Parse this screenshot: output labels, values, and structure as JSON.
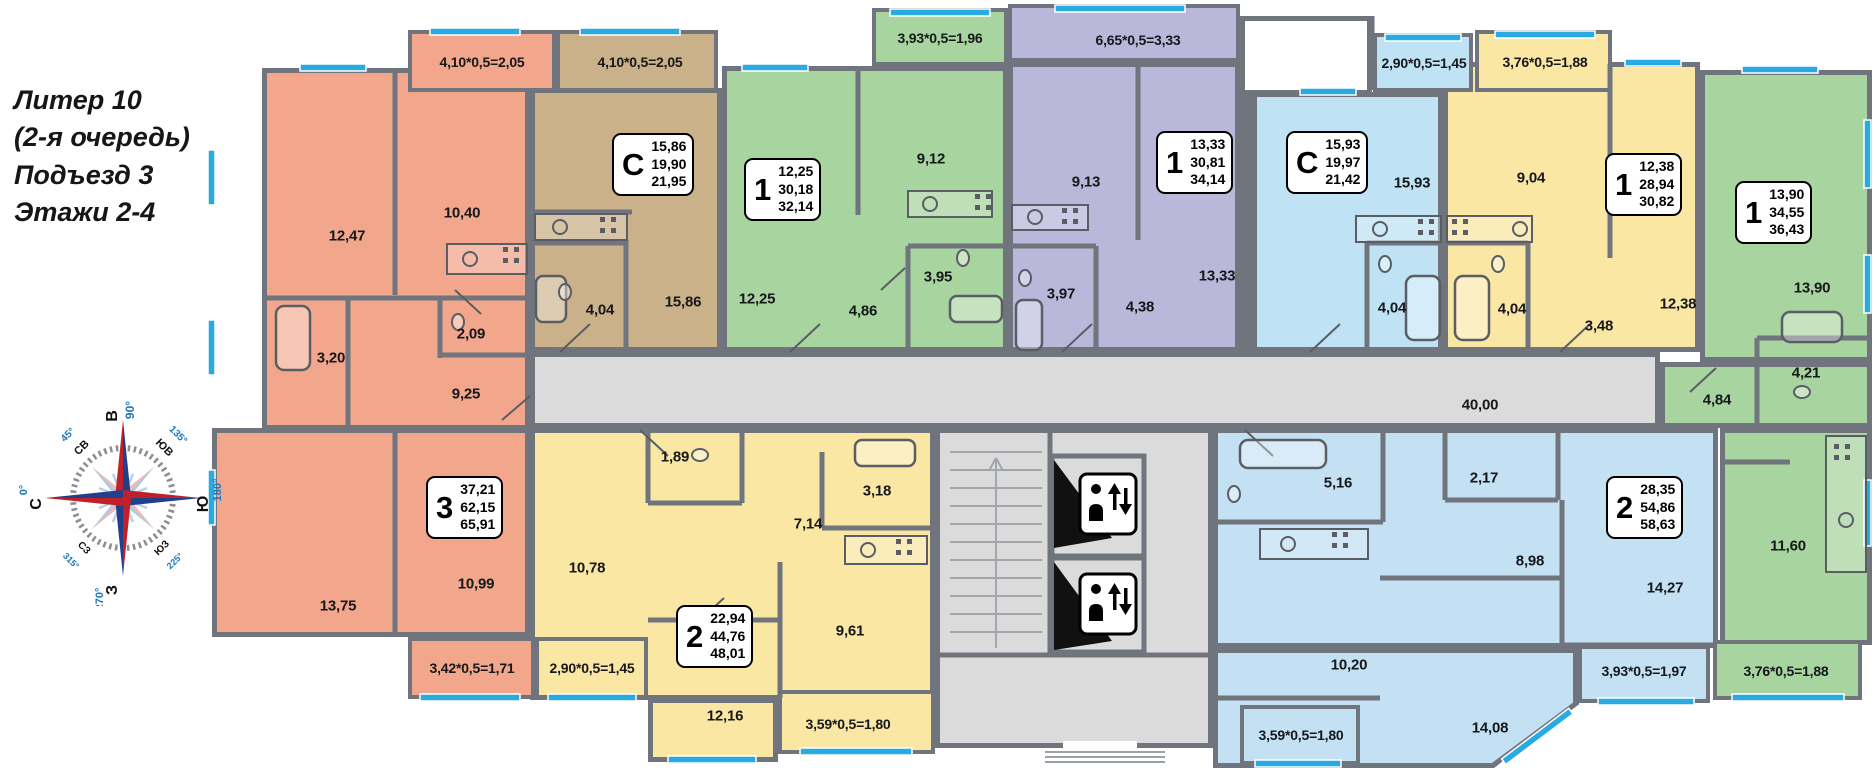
{
  "header": {
    "title_lines": [
      "Литер 10",
      "(2-я очередь)",
      "Подъезд 3",
      "Этажи 2-4"
    ]
  },
  "compass": {
    "directions": [
      {
        "label": "В",
        "deg": "90°"
      },
      {
        "label": "Ю",
        "deg": "180°"
      },
      {
        "label": "З",
        "deg": "270°"
      },
      {
        "label": "С",
        "deg": "0°"
      },
      {
        "label": "СВ",
        "deg": "45°"
      },
      {
        "label": "ЮВ",
        "deg": "135°"
      },
      {
        "label": "СЗ",
        "deg": "315°"
      },
      {
        "label": "ЮЗ",
        "deg": "225°"
      }
    ]
  },
  "corridor": {
    "area": "40,00"
  },
  "apartments": [
    {
      "id": "3-room-west",
      "type": "3",
      "living": "37,21",
      "area": "62,15",
      "total": "65,91",
      "rooms": [
        {
          "area": "12,47"
        },
        {
          "area": "10,40"
        },
        {
          "area": "2,09"
        },
        {
          "area": "3,20"
        },
        {
          "area": "9,25"
        },
        {
          "area": "10,99"
        },
        {
          "area": "13,75"
        }
      ],
      "balconies": [
        {
          "formula": "4,10*0,5=2,05"
        },
        {
          "formula": "3,42*0,5=1,71"
        }
      ]
    },
    {
      "id": "studio-west",
      "type": "С",
      "living": "15,86",
      "area": "19,90",
      "total": "21,95",
      "rooms": [
        {
          "area": "15,86"
        },
        {
          "area": "4,04"
        }
      ],
      "balconies": [
        {
          "formula": "4,10*0,5=2,05"
        }
      ]
    },
    {
      "id": "1-room-green-west",
      "type": "1",
      "living": "12,25",
      "area": "30,18",
      "total": "32,14",
      "rooms": [
        {
          "area": "12,25"
        },
        {
          "area": "9,12"
        },
        {
          "area": "3,95"
        },
        {
          "area": "4,86"
        }
      ],
      "balconies": [
        {
          "formula": "3,93*0,5=1,96"
        }
      ]
    },
    {
      "id": "1-room-purple",
      "type": "1",
      "living": "13,33",
      "area": "30,81",
      "total": "34,14",
      "rooms": [
        {
          "area": "13,33"
        },
        {
          "area": "9,13"
        },
        {
          "area": "3,97"
        },
        {
          "area": "4,38"
        }
      ],
      "balconies": [
        {
          "formula": "6,65*0,5=3,33"
        }
      ]
    },
    {
      "id": "studio-east",
      "type": "С",
      "living": "15,93",
      "area": "19,97",
      "total": "21,42",
      "rooms": [
        {
          "area": "15,93"
        },
        {
          "area": "4,04"
        }
      ],
      "balconies": [
        {
          "formula": "2,90*0,5=1,45"
        }
      ]
    },
    {
      "id": "1-room-yellow",
      "type": "1",
      "living": "12,38",
      "area": "28,94",
      "total": "30,82",
      "rooms": [
        {
          "area": "12,38"
        },
        {
          "area": "9,04"
        },
        {
          "area": "4,04"
        },
        {
          "area": "3,48"
        }
      ],
      "balconies": [
        {
          "formula": "3,76*0,5=1,88"
        }
      ]
    },
    {
      "id": "1-room-green-east",
      "type": "1",
      "living": "13,90",
      "area": "34,55",
      "total": "36,43",
      "rooms": [
        {
          "area": "13,90"
        },
        {
          "area": "4,21"
        },
        {
          "area": "4,84"
        },
        {
          "area": "11,60"
        }
      ],
      "balconies": [
        {
          "formula": "3,76*0,5=1,88"
        }
      ]
    },
    {
      "id": "2-room-yellow-south",
      "type": "2",
      "living": "22,94",
      "area": "44,76",
      "total": "48,01",
      "rooms": [
        {
          "area": "10,78"
        },
        {
          "area": "1,89"
        },
        {
          "area": "3,18"
        },
        {
          "area": "7,14"
        },
        {
          "area": "9,61"
        },
        {
          "area": "12,16"
        }
      ],
      "balconies": [
        {
          "formula": "2,90*0,5=1,45"
        },
        {
          "formula": "3,59*0,5=1,80"
        }
      ]
    },
    {
      "id": "2-room-blue-south",
      "type": "2",
      "living": "28,35",
      "area": "54,86",
      "total": "58,63",
      "rooms": [
        {
          "area": "5,16"
        },
        {
          "area": "2,17"
        },
        {
          "area": "8,98"
        },
        {
          "area": "14,27"
        },
        {
          "area": "10,20"
        },
        {
          "area": "14,08"
        }
      ],
      "balconies": [
        {
          "formula": "3,59*0,5=1,80"
        },
        {
          "formula": "3,93*0,5=1,97"
        }
      ]
    }
  ]
}
